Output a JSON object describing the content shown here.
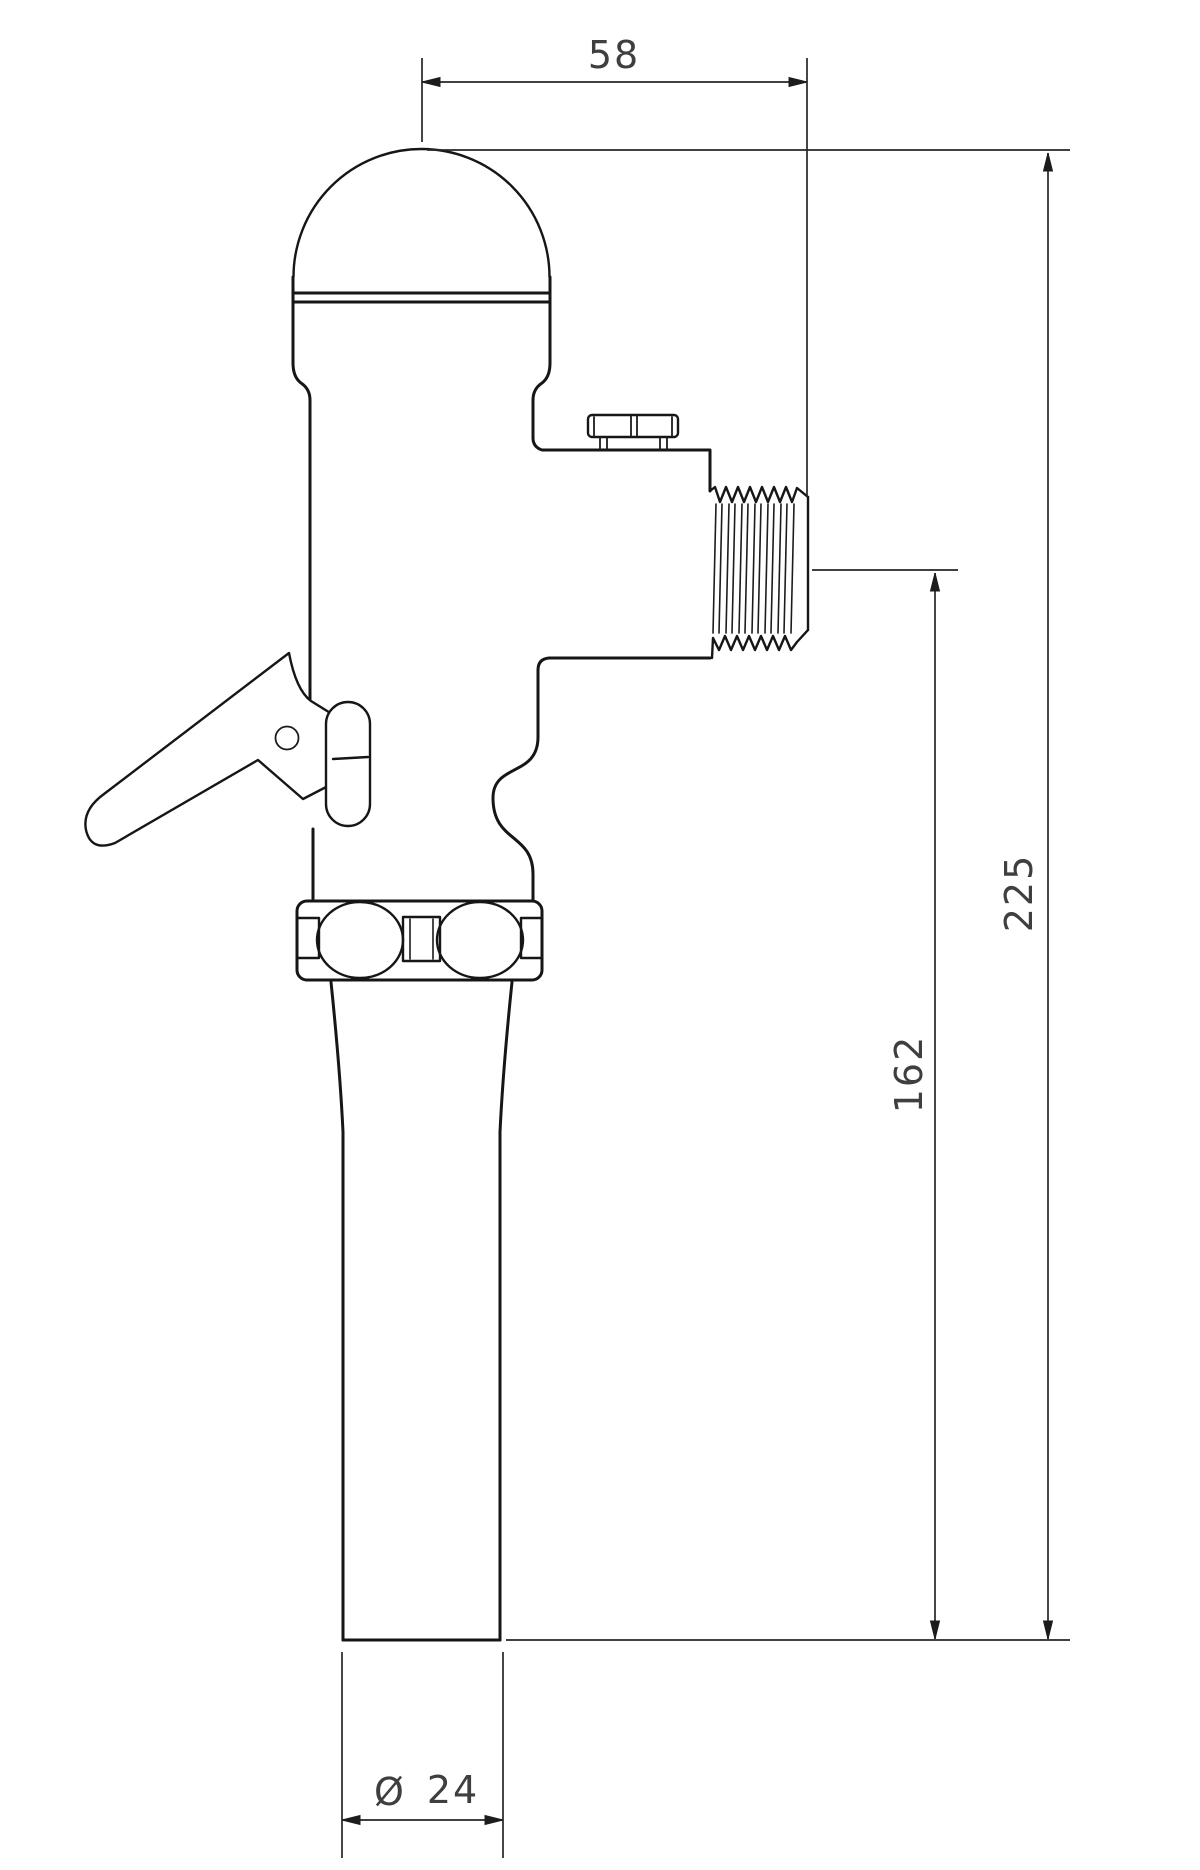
{
  "drawing": {
    "kind": "flush-valve side elevation technical drawing",
    "colors": {
      "background": "#ffffff",
      "outline": "#161616",
      "dimension_line": "#262626",
      "dimension_text": "#3f3f3f"
    },
    "dimensions": {
      "top_width": "58",
      "overall_height": "225",
      "outlet_center_to_base": "162",
      "diameter_symbol": "Ø",
      "tube_diameter": "24"
    }
  }
}
